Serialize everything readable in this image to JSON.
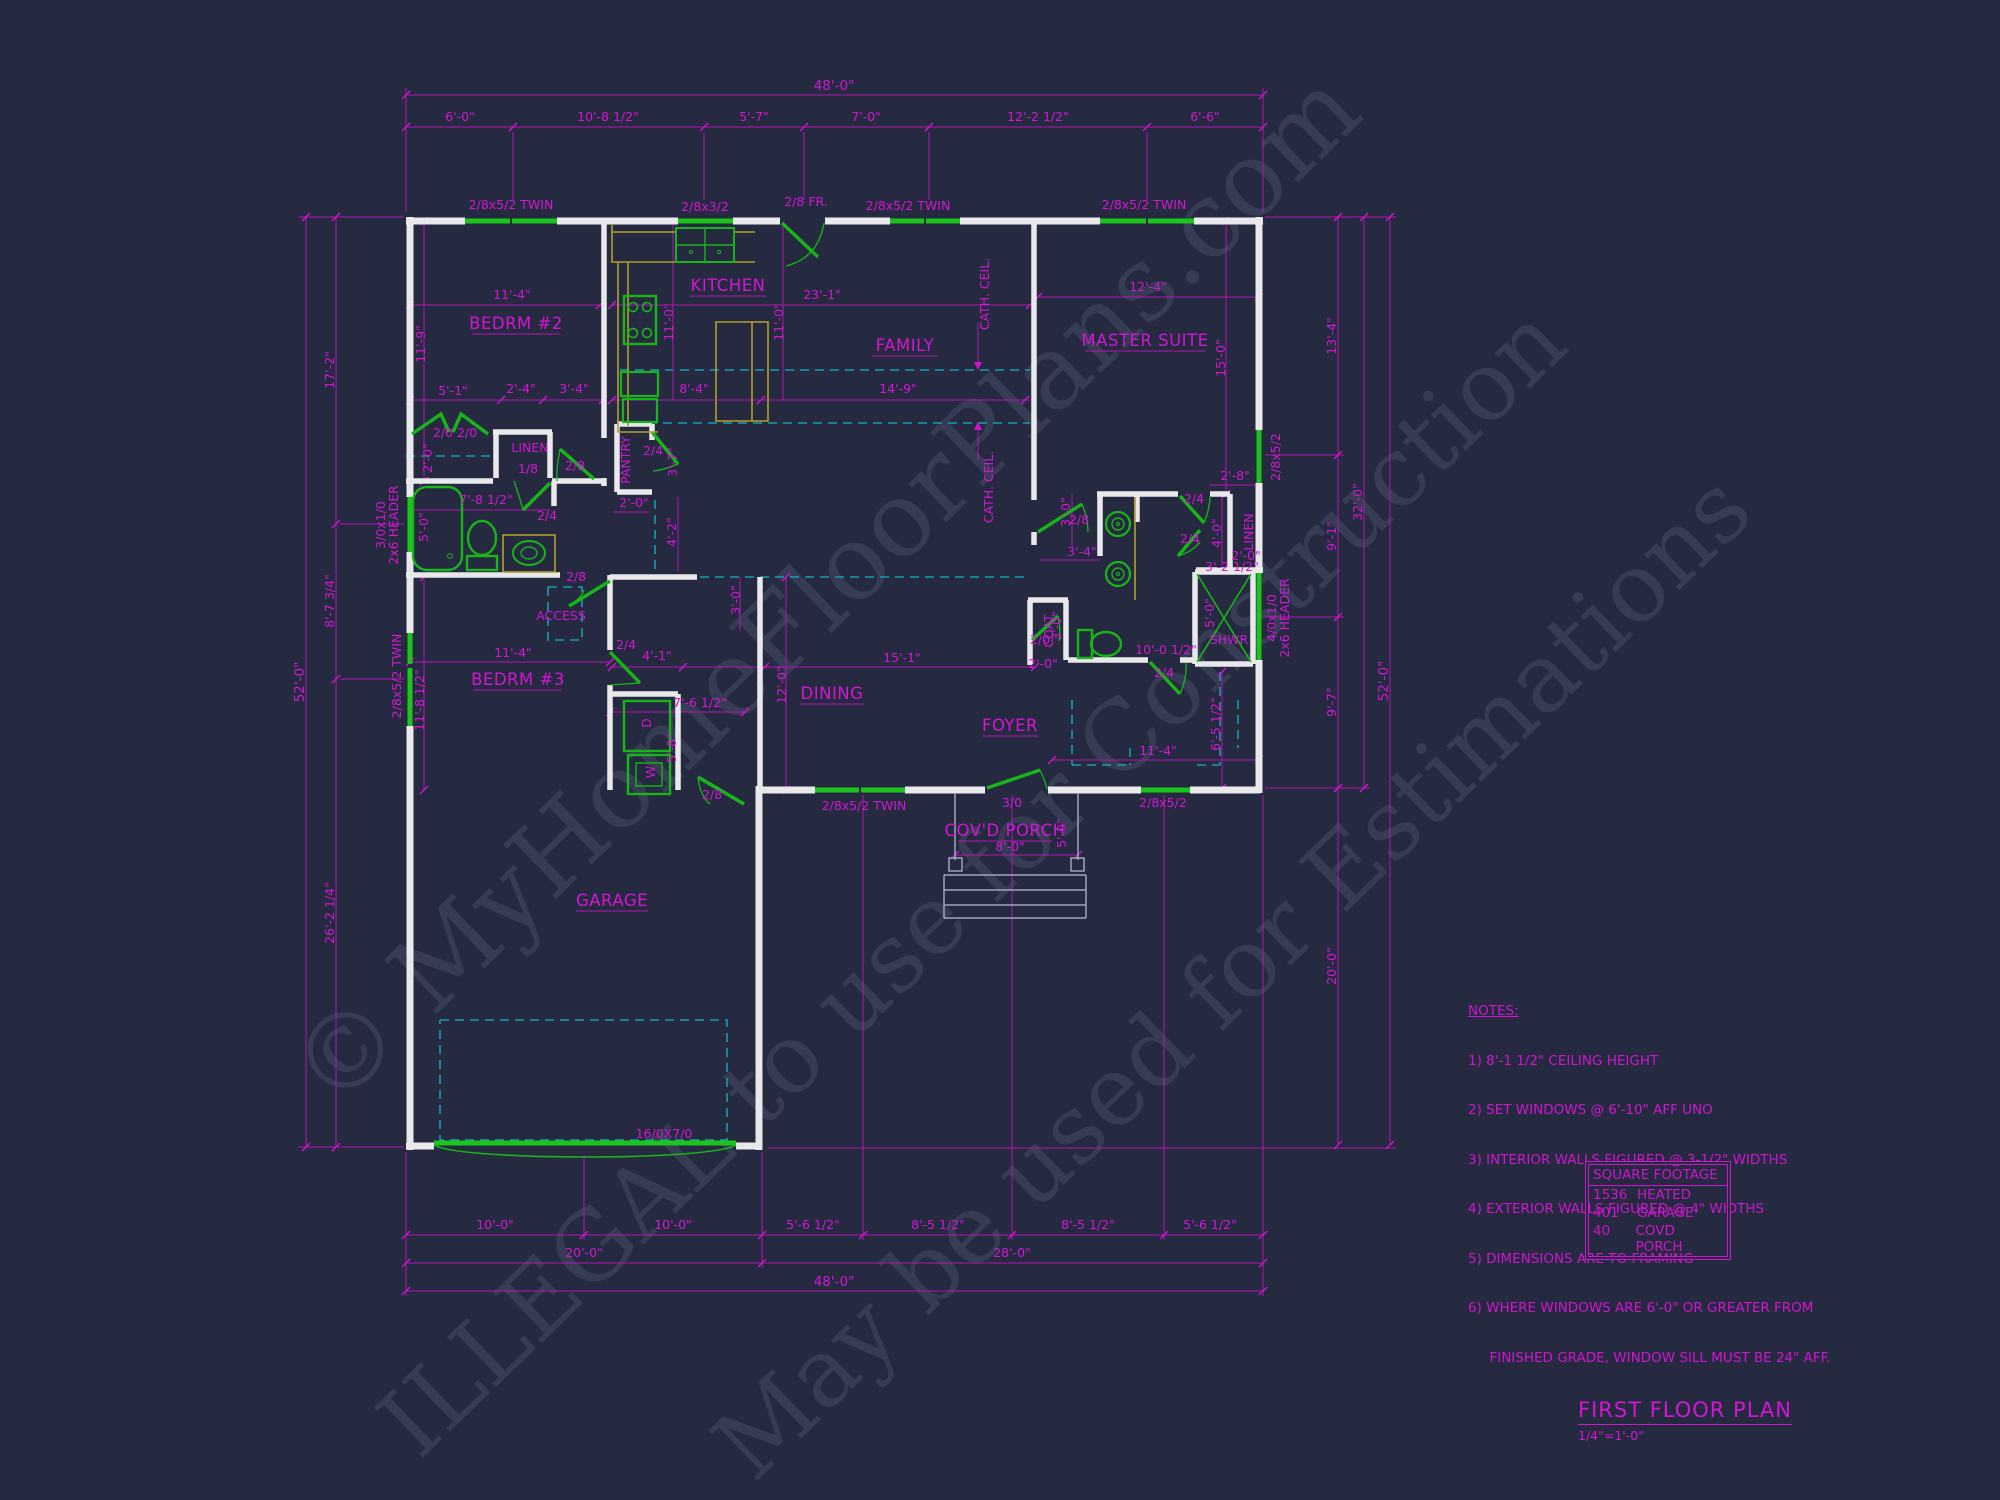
{
  "titleblock": {
    "title": "FIRST FLOOR PLAN",
    "scale": "1/4\"=1'-0\""
  },
  "watermarks": {
    "l1": "© MyHomeFloorPlans.com",
    "l2": "ILLEGAL to use for Construction",
    "l3": "May be used for Estimations"
  },
  "notes": {
    "heading": "NOTES:",
    "lines": [
      "1) 8'-1 1/2\" CEILING HEIGHT",
      "2) SET WINDOWS @ 6'-10\" AFF UNO",
      "3) INTERIOR WALLS FIGURED @ 3-1/2\" WIDTHS",
      "4) EXTERIOR WALLS FIGURED @ 4\" WIDTHS",
      "5) DIMENSIONS ARE TO FRAMING",
      "6) WHERE WINDOWS ARE 6'-0\" OR GREATER FROM",
      "     FINISHED GRADE, WINDOW SILL MUST BE 24\" AFF."
    ]
  },
  "sqft": {
    "header": "SQUARE FOOTAGE",
    "rows": [
      {
        "value": "1536",
        "label": "HEATED"
      },
      {
        "value": "401",
        "label": "GARAGE"
      },
      {
        "value": "40",
        "label": "COVD PORCH"
      }
    ]
  },
  "rooms": {
    "bedrm2": "BEDRM #2",
    "kitchen": "KITCHEN",
    "family": "FAMILY",
    "master": "MASTER SUITE",
    "bedrm3": "BEDRM #3",
    "dining": "DINING",
    "foyer": "FOYER",
    "porch": "COV'D PORCH",
    "garage": "GARAGE",
    "linen1": "LINEN",
    "pantry": "PANTRY",
    "access": "ACCESS",
    "coat": "COAT",
    "linen2": "LINEN",
    "shwr": "SHWR",
    "dryer": "D",
    "washer": "W",
    "cath1": "CATH. CEIL.",
    "cath2": "CATH. CEIL."
  },
  "labels": {
    "dim_top_total": "48'-0\"",
    "dim_top_1": "6'-0\"",
    "dim_top_2": "10'-8 1/2\"",
    "dim_top_3": "5'-7\"",
    "dim_top_4": "7'-0\"",
    "dim_top_5": "12'-2 1/2\"",
    "dim_top_6": "6'-6\"",
    "dim_bot_1": "10'-0\"",
    "dim_bot_2": "10'-0\"",
    "dim_bot_3": "5'-6 1/2\"",
    "dim_bot_4": "8'-5 1/2\"",
    "dim_bot_5": "8'-5 1/2\"",
    "dim_bot_6": "5'-6 1/2\"",
    "dim_bot_7": "20'-0\"",
    "dim_bot_8": "28'-0\"",
    "dim_bot_9": "48'-0\"",
    "dim_left_total": "52'-0\"",
    "dim_left_1": "17'-2\"",
    "dim_left_2": "8'-7 3/4\"",
    "dim_left_3": "26'-2 1/4\"",
    "dim_right_1": "13'-4\"",
    "dim_right_2": "9'-1\"",
    "dim_right_3": "9'-7\"",
    "dim_right_4": "20'-0\"",
    "dim_right_32": "32'-0\"",
    "dim_right_total": "52'-0\"",
    "win_top_1": "2/8x5/2 TWIN",
    "win_top_2": "2/8x3/2",
    "door_fr": "2/8 FR.",
    "win_top_3": "2/8x5/2 TWIN",
    "win_top_4": "2/8x5/2 TWIN",
    "win_left_1a": "3/0x1/0",
    "win_left_1b": "2x6 HEADER",
    "win_left_2": "2/8x5/2 TWIN",
    "win_right_1": "2/8x5/2",
    "win_right_2a": "4/0x1/0",
    "win_right_2b": "2x6 HEADER",
    "win_bot_1": "2/8x5/2 TWIN",
    "win_bot_2": "2/8x5/2",
    "garage_door": "16/0X7/0",
    "d_bifold": "2/0 2/0",
    "d_linen": "1/8",
    "d_hall": "2/8",
    "d_bath": "2/4",
    "d_pantry": "2/4",
    "d_access": "2/8",
    "d_bed3": "2/4",
    "d_laundry": "2/8",
    "d_foyer": "3/0",
    "d_mhall": "2/8",
    "d_mbath1": "2/4",
    "d_mbath2": "2/4",
    "d_coat": "2/0",
    "d_wc": "2/4",
    "i_11_4a": "11'-4\"",
    "i_11_9": "11'-9\"",
    "i_23_1": "23'-1\"",
    "i_11_0a": "11'-0\"",
    "i_11_0b": "11'-0\"",
    "i_12_4": "12'-4\"",
    "i_15_0": "15'-0\"",
    "i_5_1": "5'-1\"",
    "i_2_4": "2'-4\"",
    "i_3_4a": "3'-4\"",
    "i_8_4": "8'-4\"",
    "i_14_9": "14'-9\"",
    "i_2_0a": "2'-0\"",
    "i_7_8": "7'-8 1/2\"",
    "i_5_0a": "5'-0\"",
    "i_2_0b": "2'-0\"",
    "i_3_7": "3'-7\"",
    "i_4_2": "4'-2\"",
    "i_3_0a": "3'-0\"",
    "i_4_1": "4'-1\"",
    "i_11_4b": "11'-4\"",
    "i_11_8": "11'-8 1/2\"",
    "i_7_6": "7'-6 1/2\"",
    "i_5_8": "5'-8\"",
    "i_12_0": "12'-0\"",
    "i_15_1": "15'-1\"",
    "i_3_4b": "3'-4\"",
    "i_3_0b": "3'-0\"",
    "i_2_8": "2'-8\"",
    "i_4_0": "4'-0\"",
    "i_2_0c": "2'-0\"",
    "i_3_2": "3'-2 1/2\"",
    "i_5_0b": "5'-0\"",
    "i_10_0": "10'-0 1/2\"",
    "i_11_4c": "11'-4\"",
    "i_6_5": "6'-5 1/2\"",
    "i_8_0": "8'-0\"",
    "i_5_0c": "5'-0\"",
    "i_2_0d": "2'-0\"",
    "i_3_0c": "3'-0\""
  }
}
